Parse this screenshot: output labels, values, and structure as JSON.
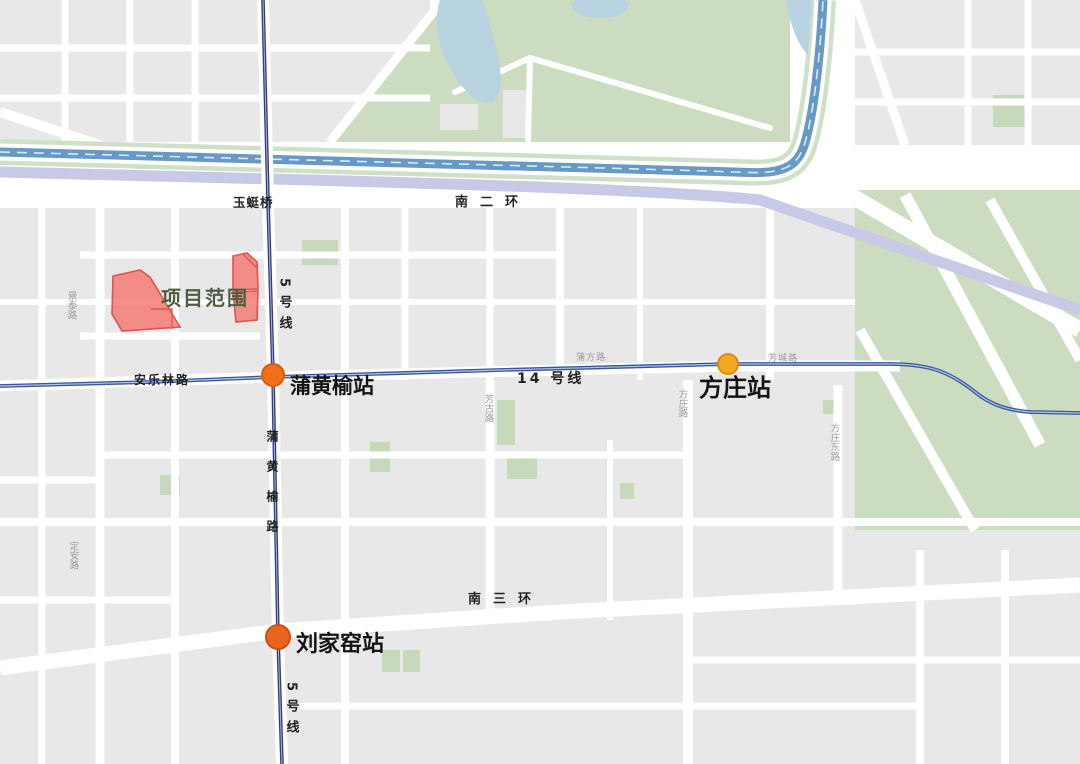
{
  "map": {
    "project_area": {
      "label": "项目范围",
      "label_color": "#4e5c42",
      "fill": "#f5837d",
      "stroke": "#e0433c"
    },
    "metro": {
      "line5": {
        "label": "5号线",
        "color": "#323c85"
      },
      "line14": {
        "label": "14 号线",
        "color": "#3a569f"
      }
    },
    "stations": {
      "puhuangyu": {
        "name": "蒲黄榆站",
        "dot_color": "#ee7118",
        "dot_stroke": "#d85c0e"
      },
      "fangzhuang": {
        "name": "方庄站",
        "dot_color": "#f2a820",
        "dot_stroke": "#dd8a12"
      },
      "liujiayao": {
        "name": "刘家窑站",
        "dot_color": "#e9641c",
        "dot_stroke": "#cf4f12"
      }
    },
    "roads": {
      "nanerhuan": "南二环",
      "nansanhuan": "南三环",
      "anlelin": "安乐林路",
      "puhuangyulu": "蒲黄榆路",
      "yutingqiao": "玉蜓桥",
      "jingtai": "景泰路",
      "dingan": "定安路",
      "pufang": "蒲方路",
      "fangcheng": "芳城路",
      "fangzhuanglu": "方庄路",
      "fanggu": "芳古路",
      "fangzhuangdong": "方庄东路"
    }
  },
  "colors": {
    "block": "#e8e8e9",
    "park_green": "#cbdcc1",
    "green_patch": "#c6d9ba",
    "river_blue": "#6699c8",
    "pond_blue": "#b7d2e0",
    "ringroad_lavender": "#c8c9e6",
    "street_white": "#ffffff"
  }
}
